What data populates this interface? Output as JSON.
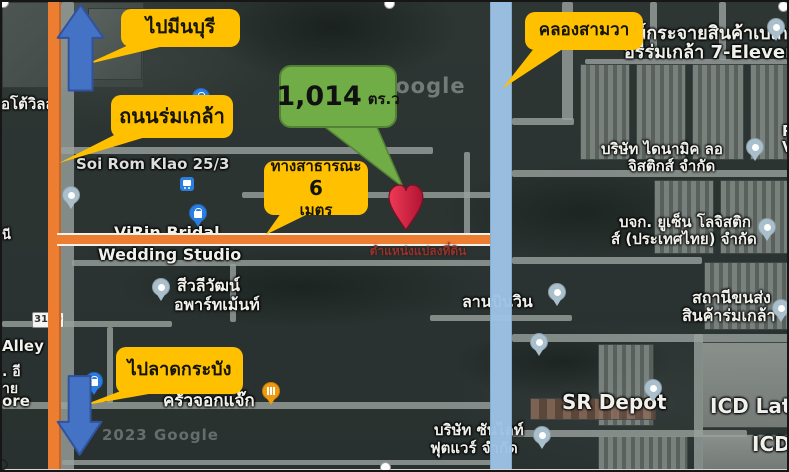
{
  "callouts": {
    "to_min_buri": "ไปมีนบุรี",
    "rom_klao_road": "ถนนร่มเกล้า",
    "khlong_sam_wa": "คลองสามวา",
    "public_way_line1": "ทางสาธารณะ",
    "public_way_number": "6",
    "public_way_line2": "เมตร",
    "to_lat_krabang": "ไปลาดกระบัง",
    "area_value": "1,014",
    "area_unit": "ตร.ว",
    "plot_position": "ตำแหน่งแปลงที่ดิน"
  },
  "map": {
    "watermark_center": "Google",
    "watermark_bottom": "2023 Google",
    "route_shield": "3119",
    "labels": {
      "soi_rom_klao": "Soi Rom Klao 25/3",
      "virin_line1": "ViRin Bridal",
      "virin_line2": "Wedding Studio",
      "sivali_line1": "สีวลีวัฒน์",
      "sivali_line2": "อพาร์ทเม้นท์",
      "bakery_line1": "ศูนย์กระจายสินค้าเบเก",
      "bakery_line2": "อรี่ร่มเกล้า 7-Eleven",
      "dynamic_line1": "บริษัท ไดนามิค ลอ",
      "dynamic_line2": "จิสติกส์ จำกัด",
      "yusen_line1": "บจก. ยูเซ็น โลจิสติก",
      "yusen_line2": "ส์ (ประเทศไทย) จำกัด",
      "station_line1": "สถานีขนส่ง",
      "station_line2": "สินค้าร่มเกล้า",
      "lan_bin_win": "ลานบินวิน",
      "sr_depot": "SR Depot",
      "icd_lat_k": "ICD Lat K",
      "icd": "ICD",
      "krua_jok_jaek": "ครัวจอกแจ๊ก",
      "sunlight_line1": "บริษัท ซันไลท์",
      "sunlight_line2": "ฟุตแวร์ จำกัด",
      "auto_vil": "ออโต้วิลล",
      "ni_fragment": "นี",
      "alley_fragment": "Alley",
      "ee_fragment": ". อี",
      "ai_fragment": "าย",
      "ore_fragment": "ore",
      "r_fragment": "R",
      "v_fragment": "V"
    }
  },
  "colors": {
    "highlight_orange": "#ED7D31",
    "canal_blue": "#9DC3E6",
    "callout_yellow": "#FFC000",
    "callout_green": "#70AD47",
    "arrow_blue": "#4472C4",
    "pin_red": "#D61F3E"
  }
}
